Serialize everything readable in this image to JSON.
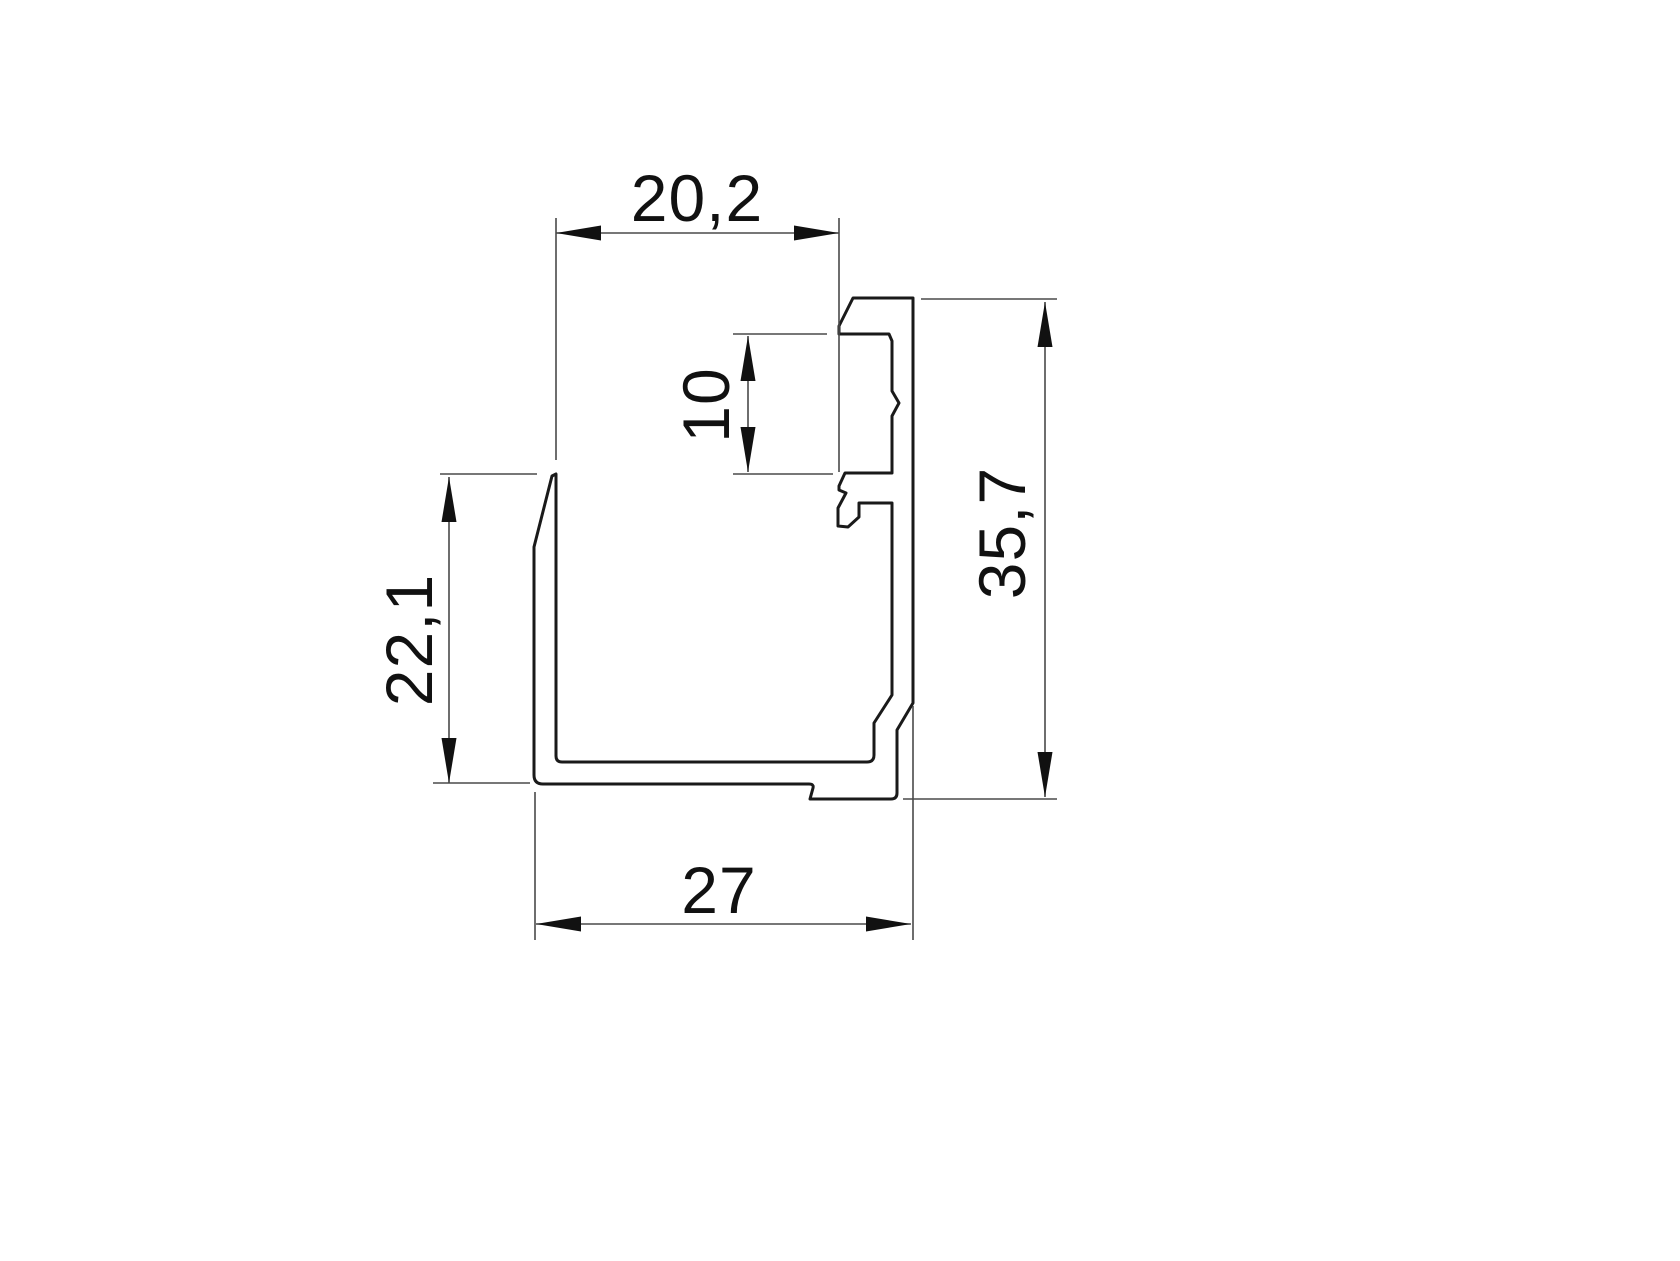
{
  "drawing": {
    "kind": "technical-cross-section",
    "subject": "aluminium-glazing-channel-profile",
    "units": "mm",
    "dimensions": {
      "top_opening_width": "20,2",
      "bead_groove_height": "10",
      "overall_height": "35,7",
      "front_wall_height": "22,1",
      "overall_width": "27"
    },
    "colors": {
      "background": "#ffffff",
      "outline": "#1a1a1a",
      "dimension_lines": "#4a4a4a",
      "text": "#111111"
    }
  }
}
